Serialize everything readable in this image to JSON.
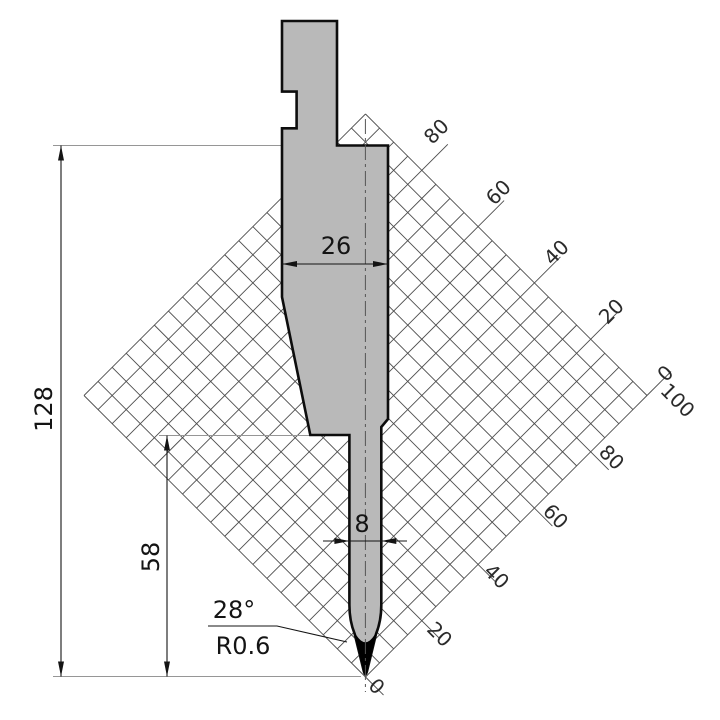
{
  "drawing": {
    "kind": "press-brake punch profile with working-height grid"
  },
  "dims": {
    "total_height": "128",
    "working_height": "58",
    "body_width": "26",
    "shaft_width": "8",
    "tip_angle": "28°",
    "tip_radius": "R0.6"
  },
  "grid": {
    "top_scale": [
      "80",
      "60",
      "40",
      "20",
      "0"
    ],
    "bottom_scale": [
      "100",
      "80",
      "60",
      "40",
      "20",
      "0"
    ]
  },
  "colors": {
    "background": "#ffffff",
    "punch_fill": "#b9b9b9",
    "outline": "#0d0d0d",
    "tip_fill": "#000000",
    "grid_line": "#4d4d4d",
    "grid_label": "#2b2b2b",
    "dim_color": "#141414",
    "ext_color": "#969696",
    "centerline": "#555555"
  }
}
